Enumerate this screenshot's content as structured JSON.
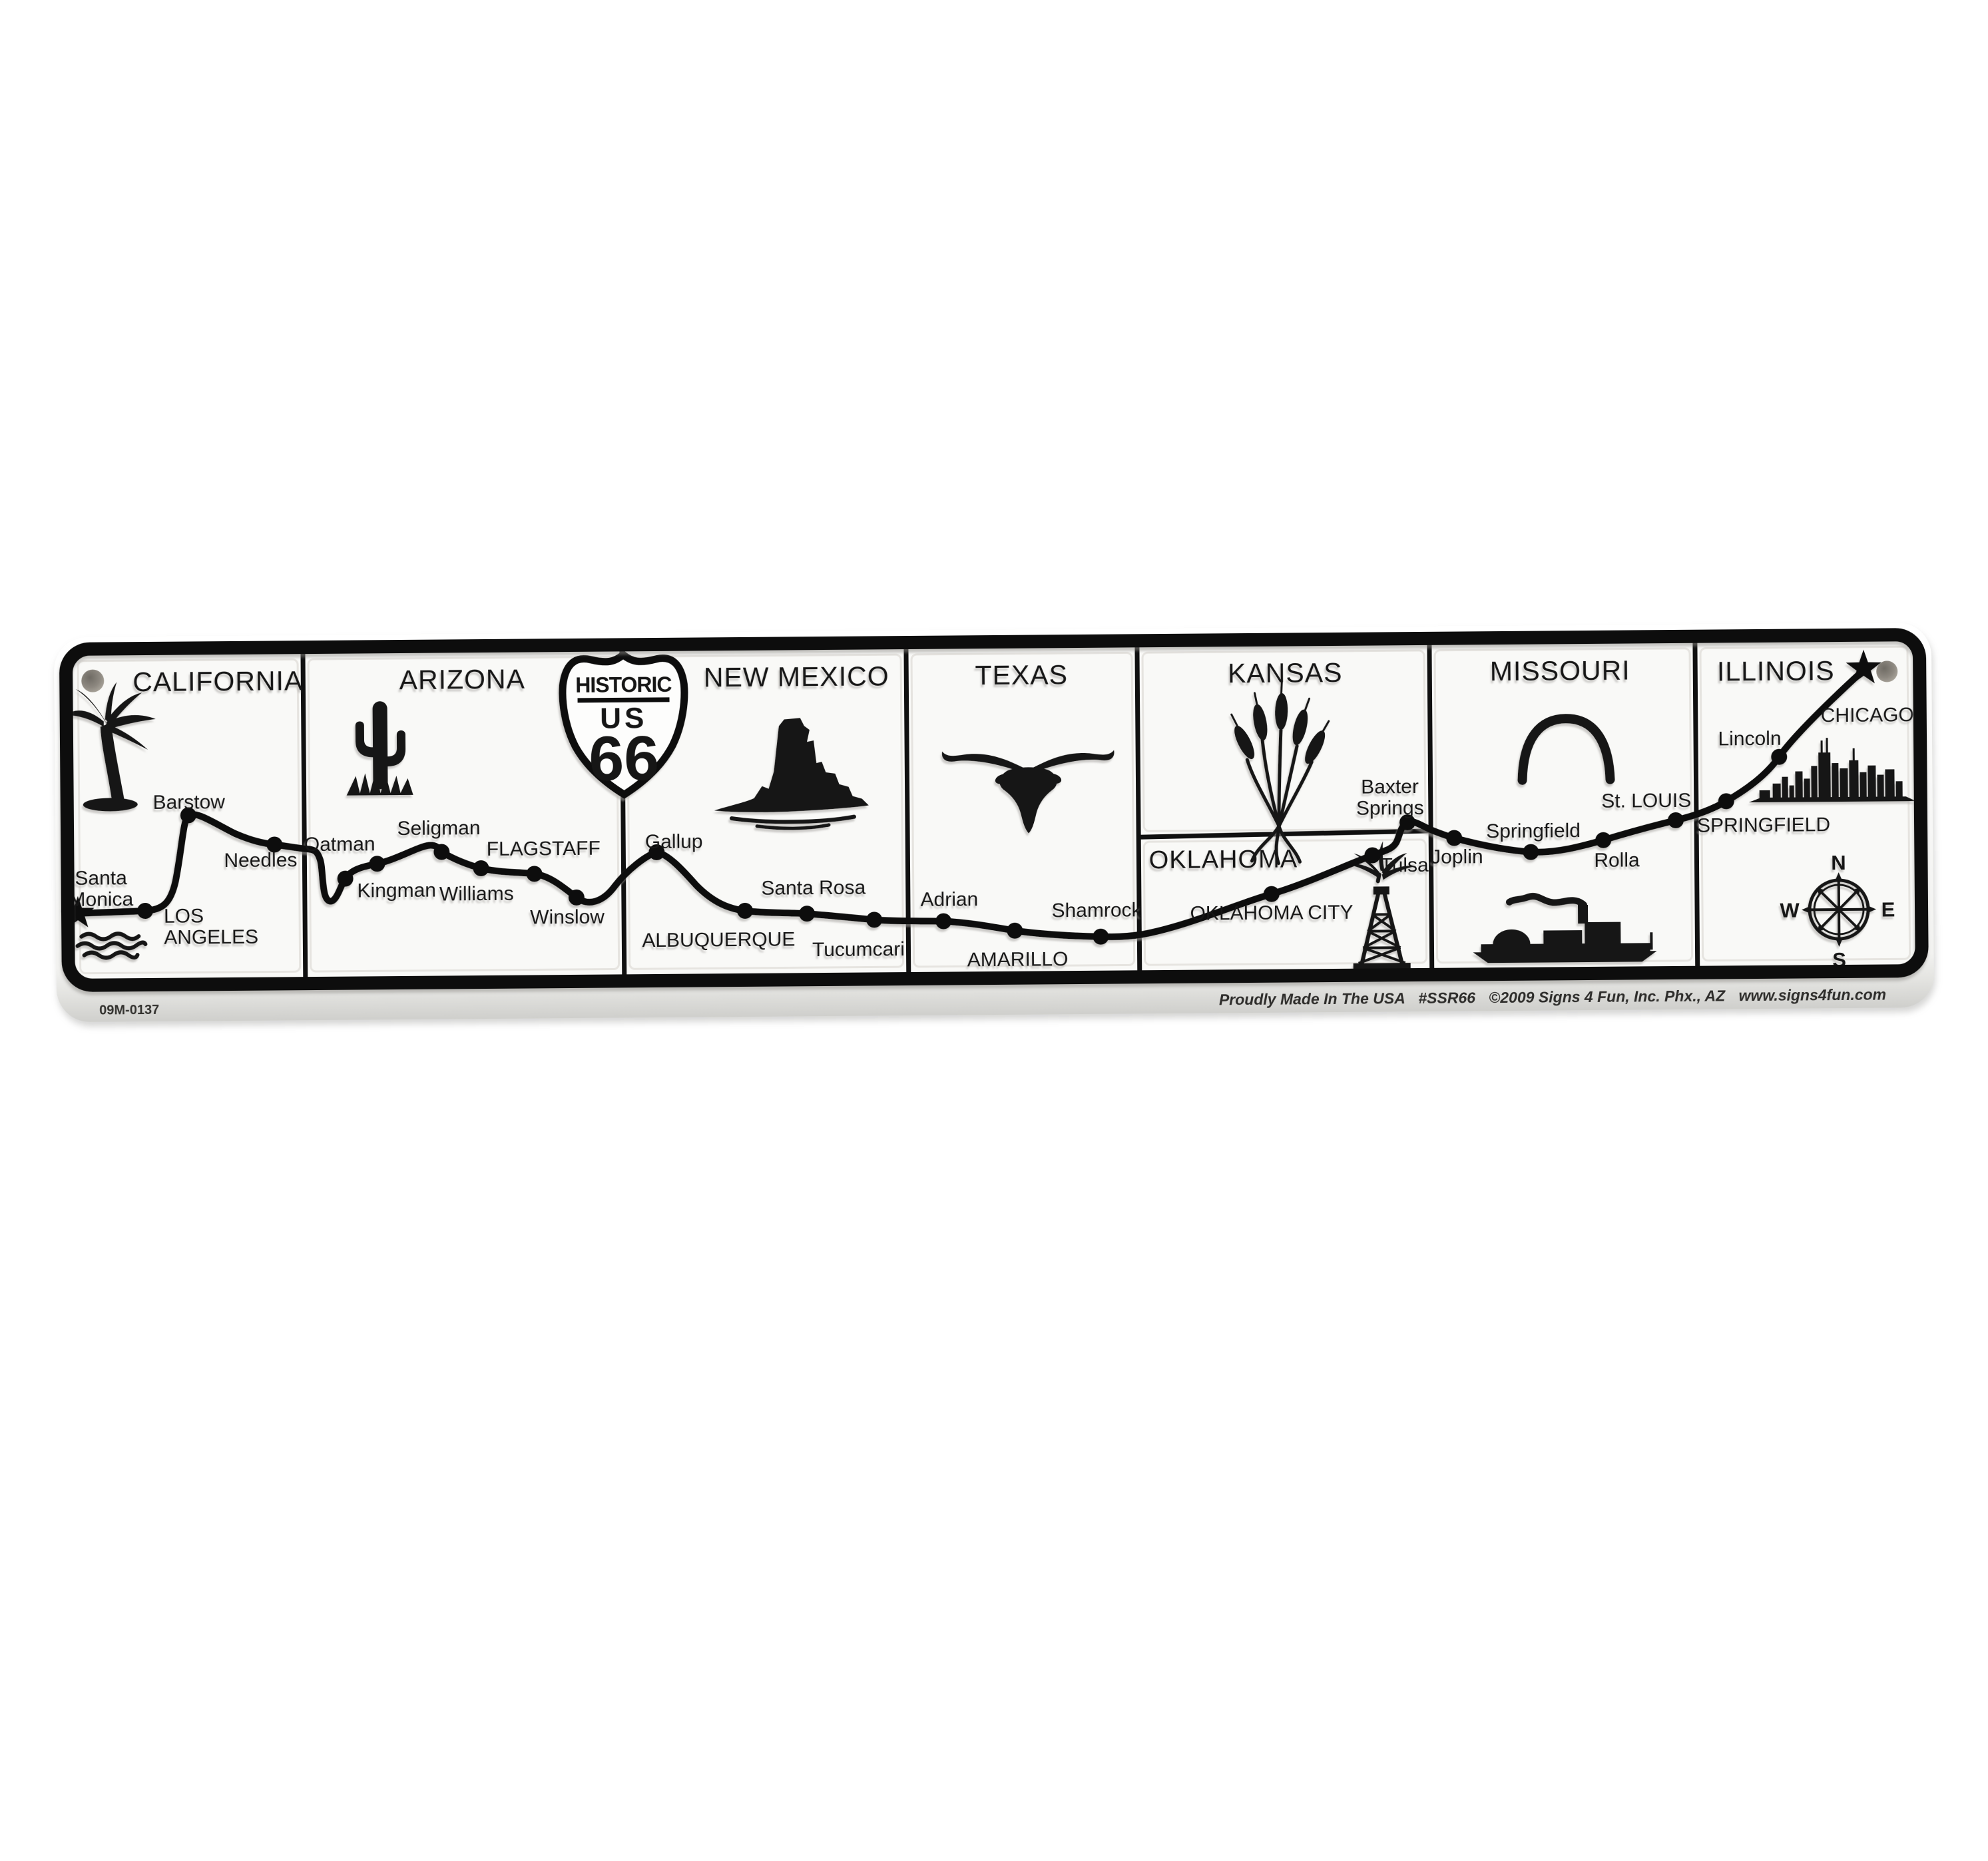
{
  "sign": {
    "serial": "09M-0137",
    "footer": {
      "made_in": "Proudly Made In The USA",
      "sku": "#SSR66",
      "copyright": "©2009 Signs 4 Fun, Inc. Phx., AZ",
      "website": "www.signs4fun.com"
    },
    "shield": {
      "historic": "HISTORIC",
      "us": "US",
      "route_number": "66"
    },
    "compass": {
      "north": "N",
      "east": "E",
      "south": "S",
      "west": "W"
    },
    "states": {
      "california": {
        "title": "CALIFORNIA",
        "santa_monica_line1": "Santa",
        "santa_monica_line2": "Monica",
        "los_angeles_line1": "LOS",
        "los_angeles_line2": "ANGELES",
        "barstow": "Barstow",
        "needles": "Needles"
      },
      "arizona": {
        "title": "ARIZONA",
        "oatman": "Oatman",
        "kingman": "Kingman",
        "seligman": "Seligman",
        "williams": "Williams",
        "flagstaff": "FLAGSTAFF",
        "winslow": "Winslow"
      },
      "new_mexico": {
        "title": "NEW MEXICO",
        "gallup": "Gallup",
        "albuquerque": "ALBUQUERQUE",
        "santa_rosa": "Santa Rosa",
        "tucumcari": "Tucumcari"
      },
      "texas": {
        "title": "TEXAS",
        "adrian": "Adrian",
        "amarillo": "AMARILLO",
        "shamrock": "Shamrock"
      },
      "kansas": {
        "title": "KANSAS",
        "baxter_springs_line1": "Baxter",
        "baxter_springs_line2": "Springs"
      },
      "oklahoma": {
        "title": "OKLAHOMA",
        "oklahoma_city": "OKLAHOMA CITY",
        "tulsa": "Tulsa"
      },
      "missouri": {
        "title": "MISSOURI",
        "joplin": "Joplin",
        "springfield": "Springfield",
        "rolla": "Rolla",
        "st_louis": "St. LOUIS"
      },
      "illinois": {
        "title": "ILLINOIS",
        "springfield": "SPRINGFIELD",
        "lincoln": "Lincoln",
        "chicago": "CHICAGO"
      }
    }
  }
}
